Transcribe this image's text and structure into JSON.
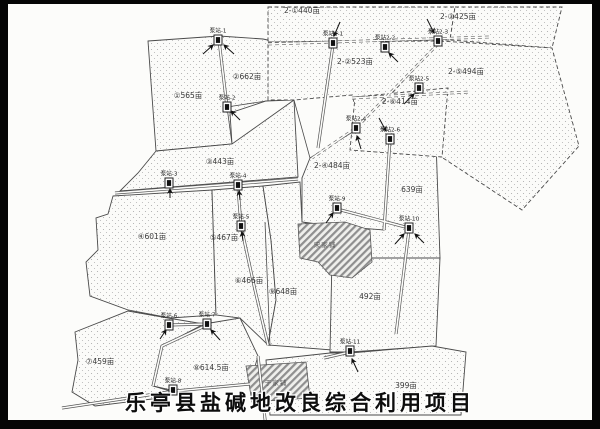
{
  "title": {
    "text": "乐亭县盐碱地改良综合利用项目"
  },
  "map": {
    "parcels": [
      {
        "label": "①565亩"
      },
      {
        "label": "②662亩"
      },
      {
        "label": "③443亩"
      },
      {
        "label": "④601亩"
      },
      {
        "label": "⑤467亩"
      },
      {
        "label": "⑥466亩"
      },
      {
        "label": "⑦459亩"
      },
      {
        "label": "⑧614.5亩"
      },
      {
        "label": "⑨648亩"
      },
      {
        "label": "2-①440亩"
      },
      {
        "label": "2-②523亩"
      },
      {
        "label": "2-③425亩"
      },
      {
        "label": "2-④484亩"
      },
      {
        "label": "2-⑤494亩"
      },
      {
        "label": "2-⑥414亩"
      },
      {
        "label": "639亩"
      },
      {
        "label": "492亩"
      },
      {
        "label": "399亩"
      }
    ],
    "pumps": [
      {
        "label": "泵站-1"
      },
      {
        "label": "泵站-2"
      },
      {
        "label": "泵站-3"
      },
      {
        "label": "泵站-4"
      },
      {
        "label": "泵站-5"
      },
      {
        "label": "泵站-6"
      },
      {
        "label": "泵站-7"
      },
      {
        "label": "泵站-8"
      },
      {
        "label": "泵站-9"
      },
      {
        "label": "泵站-10"
      },
      {
        "label": "泵站-11"
      },
      {
        "label": "泵站2-1"
      },
      {
        "label": "泵站2-2"
      },
      {
        "label": "泵站2-3"
      },
      {
        "label": "泵站2-4"
      },
      {
        "label": "泵站2-5"
      },
      {
        "label": "泵站2-6"
      }
    ],
    "villages": [
      {
        "label": "宋家铺"
      },
      {
        "label": "于家铺"
      }
    ],
    "colors": {
      "paper": "#fcfcfa",
      "line": "#4a4a4a",
      "frame": "#050505",
      "dots": "#a6a6a6",
      "title_text": "#0d0d0d"
    }
  }
}
